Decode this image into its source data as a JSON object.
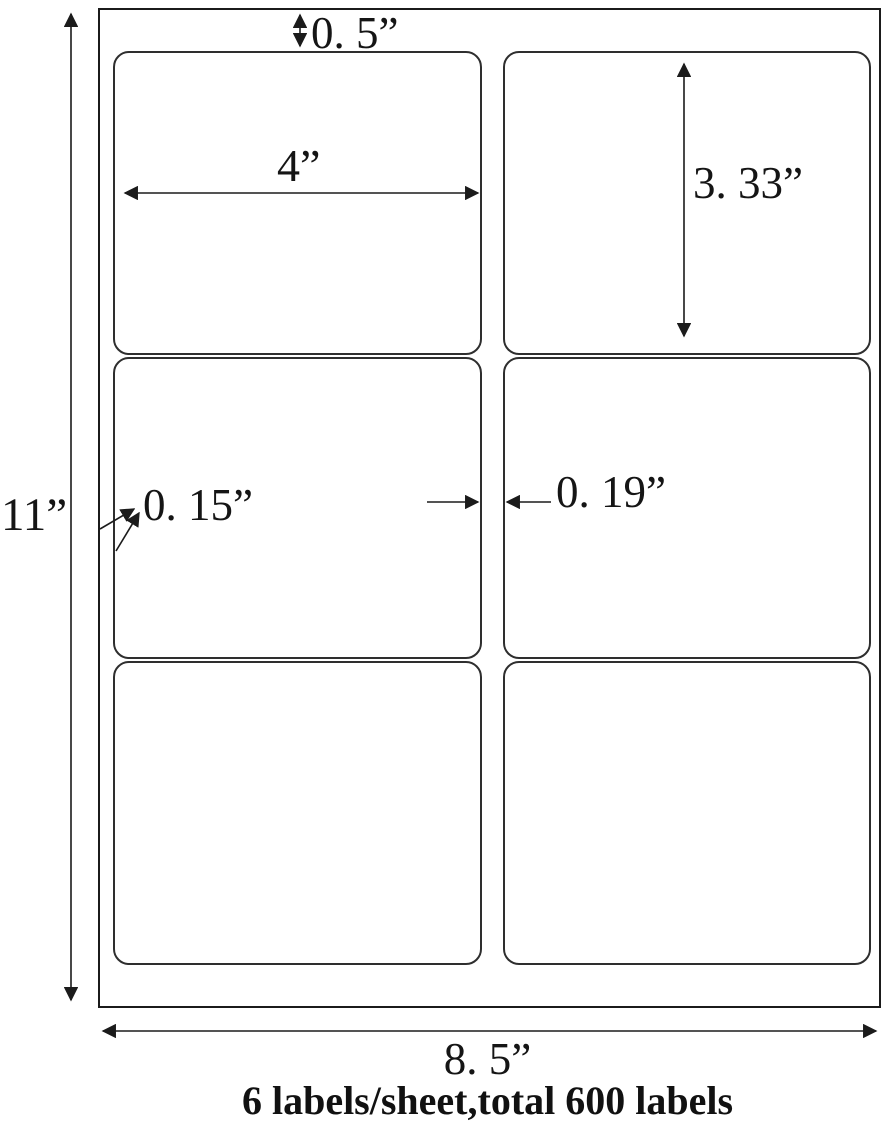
{
  "diagram": {
    "sheet_height_label": "11”",
    "sheet_width_label": "8. 5”",
    "top_margin_label": "0. 5”",
    "label_width_label": "4”",
    "label_height_label": "3. 33”",
    "side_margin_label": "0. 15”",
    "center_gap_label": "0. 19”",
    "caption": "6 labels/sheet,total 600 labels"
  },
  "layout": {
    "rows": 3,
    "columns": 2,
    "labels_per_sheet": 6,
    "total_labels": 600
  },
  "colors": {
    "ink": "#1b1b1b",
    "paper": "#ffffff",
    "label_border": "#2e2e2e"
  }
}
